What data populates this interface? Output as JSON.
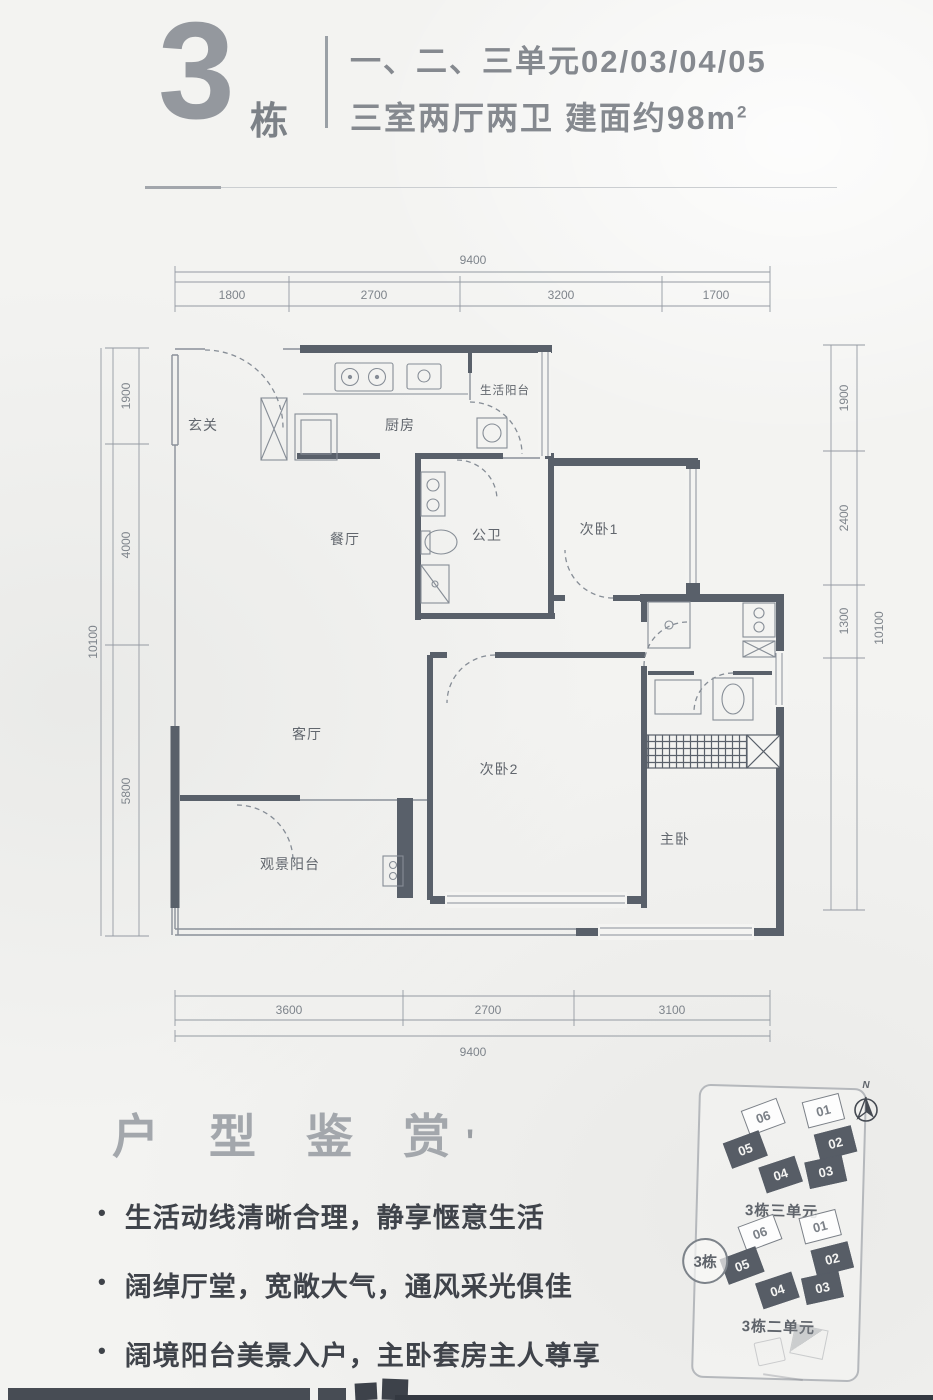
{
  "header": {
    "building_number": "3",
    "building_suffix": "栋",
    "units_line": "一、二、三单元02/03/04/05",
    "spec_line": "三室两厅两卫 建面约98m",
    "spec_sup": "2"
  },
  "floorplan": {
    "rooms": {
      "entry": "玄关",
      "kitchen": "厨房",
      "service_balcony": "生活阳台",
      "dining": "餐厅",
      "guest_bath": "公卫",
      "bedroom1": "次卧1",
      "living": "客厅",
      "bedroom2": "次卧2",
      "master": "主卧",
      "view_balcony": "观景阳台"
    },
    "dims": {
      "top": {
        "overall": "9400",
        "segments": [
          "1800",
          "2700",
          "3200",
          "1700"
        ]
      },
      "bottom": {
        "overall": "9400",
        "segments": [
          "3600",
          "2700",
          "3100"
        ]
      },
      "left": {
        "overall": "10100",
        "segments": [
          "1900",
          "4000",
          "5800"
        ]
      },
      "right": {
        "overall": "10100",
        "segments": [
          "1900",
          "2400",
          "1300"
        ]
      }
    }
  },
  "section": {
    "title": "户型鉴赏",
    "title_mark": "'",
    "bullets": [
      "生活动线清晰合理，静享惬意生活",
      "阔绰厅堂，宽敞大气，通风采光俱佳",
      "阔境阳台美景入户，主卧套房主人尊享"
    ]
  },
  "sitemap": {
    "compass_label": "N",
    "badge": "3栋",
    "clusters": [
      {
        "label": "3栋三单元",
        "units": [
          {
            "label": "06",
            "filled": "false"
          },
          {
            "label": "01",
            "filled": "false"
          },
          {
            "label": "02",
            "filled": "true"
          },
          {
            "label": "03",
            "filled": "true"
          },
          {
            "label": "04",
            "filled": "true"
          },
          {
            "label": "05",
            "filled": "true"
          }
        ]
      },
      {
        "label": "3栋二单元",
        "units": [
          {
            "label": "06",
            "filled": "false"
          },
          {
            "label": "01",
            "filled": "false"
          },
          {
            "label": "02",
            "filled": "true"
          },
          {
            "label": "03",
            "filled": "true"
          },
          {
            "label": "04",
            "filled": "true"
          },
          {
            "label": "05",
            "filled": "true"
          }
        ]
      }
    ]
  },
  "colors": {
    "wall": "#59606a",
    "header_text": "#85898f",
    "body_text": "#3f434a",
    "unit_highlight": "#575d66"
  }
}
